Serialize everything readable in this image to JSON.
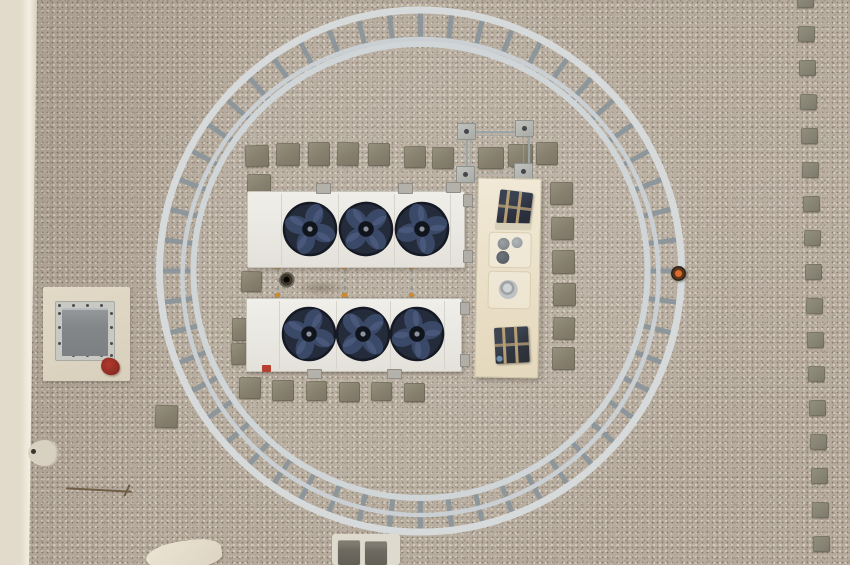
{
  "scene": {
    "title": "Aerial rooftop HVAC installation",
    "description": "Top-down drone photo of a gravel roof: a circular metal guardrail ring enclosing two three-fan condenser units and a cream control cabinet, concrete step pavers, a roof access hatch on a cream pad at left, a cream roof edge strip along the left border, and a vertical dotted line of small square pavers on the right",
    "view": "top-down aerial",
    "surface": "pea-gravel ballast roof"
  },
  "objects": {
    "guardrail_ring": {
      "label": "circular guardrail walkway ring",
      "rung_count": 52
    },
    "condenser_unit_upper": {
      "label": "rooftop condenser unit",
      "fan_count": 3
    },
    "condenser_unit_lower": {
      "label": "rooftop condenser unit",
      "fan_count": 3
    },
    "connecting_rails": {
      "label": "refrigerant line rails between units",
      "count": 3
    },
    "control_cabinet": {
      "label": "control cabinet",
      "components": [
        "caged device top",
        "knob panel",
        "round gauge cylinder",
        "caged device bottom"
      ]
    },
    "mounting_frame": {
      "label": "anchor frame with four base plates",
      "plate_count": 4
    },
    "roof_hatch": {
      "label": "roof access hatch with glass panel on cream pad"
    },
    "red_object": {
      "label": "small red object beside hatch"
    },
    "scattered_pavers": {
      "label": "concrete step pavers around equipment",
      "count": 27
    },
    "dotted_paver_line": {
      "label": "vertical dotted paver walkway",
      "count": 17
    },
    "bottom_pad": {
      "label": "white pad with two dark pavers at ring bottom"
    },
    "cloth": {
      "label": "light tarp fragment at bottom edge"
    },
    "stick": {
      "label": "thin rod or tool on gravel"
    },
    "ball_marker": {
      "label": "small dark knob with orange center on ring right side"
    },
    "drain": {
      "label": "small round drain between units"
    }
  },
  "colors": {
    "gravel_base": "#b5aa9c",
    "edge_strip": "#e9e2d2",
    "ring_rail": "#d6dadb",
    "ring_rail_mid": "#c9cfd2",
    "ring_rail_inner": "#d0d5d7",
    "ring_rung": "#8c969b",
    "unit_body": "#eae8e2",
    "fan_face": "#242b3b",
    "fan_rim": "#141924",
    "fan_blade": "#3d4c6b",
    "fan_blade_hi": "#55648a",
    "fan_hub": "#10141c",
    "fan_hub_dot": "#8d939c",
    "paver": "#8a8476",
    "paver_dark": "#6e6a61",
    "cabinet": "#eadfc7",
    "cage_device": "#313744",
    "cage_strap": "#b59d74",
    "cylinder": "#c0c3c4",
    "hatch_pad": "#ddd5c1",
    "hatch_frame": "#c9c9c3",
    "hatch_glass": "#84878a",
    "red_object": "#9b2f27",
    "orange_clamp": "#d08a2e",
    "metal_plate": "#b4b6b2"
  }
}
